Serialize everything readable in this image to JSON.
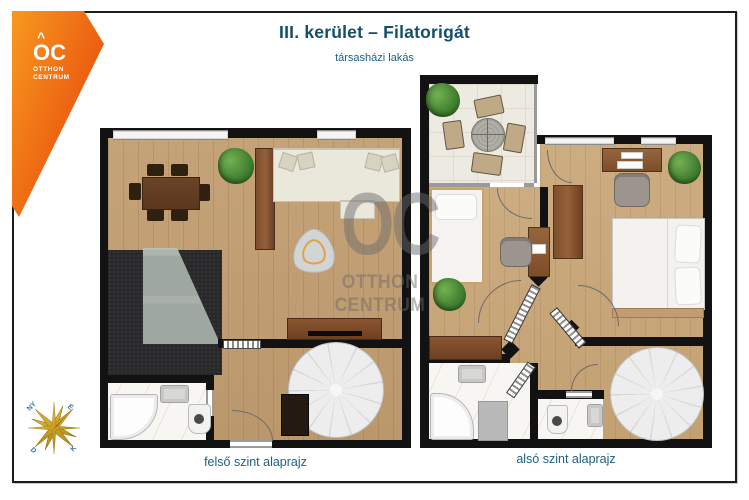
{
  "header": {
    "title": "III. kerület – Filatorigát",
    "subtitle": "társasházi lakás"
  },
  "logo": {
    "roof": "^",
    "mark": "OC",
    "line1": "OTTHON",
    "line2": "CENTRUM"
  },
  "watermark": {
    "mark": "OC",
    "line1": "OTTHON",
    "line2": "CENTRUM"
  },
  "plans": {
    "upper": {
      "caption": "felső szint alaprajz"
    },
    "lower": {
      "caption": "alsó szint alaprajz"
    }
  },
  "compass": {
    "north": "É",
    "east": "K",
    "south": "D",
    "west": "NY"
  },
  "colors": {
    "accent": "#e84c0c",
    "accent-light": "#f8991f",
    "title": "#124f6b",
    "caption": "#1d6183",
    "wall": "#121212",
    "wood": "#c5a378",
    "wood2": "#ccac81",
    "terrace": "#edeae1",
    "marble": "#f7f6f3",
    "dark": "#29292b",
    "glass": "#a9b3ab",
    "stair": "#ededed",
    "wm": "#6b6b6b",
    "gold": "#d8a41c",
    "needle": "#d22b00",
    "compass-label": "#3c74ad"
  }
}
